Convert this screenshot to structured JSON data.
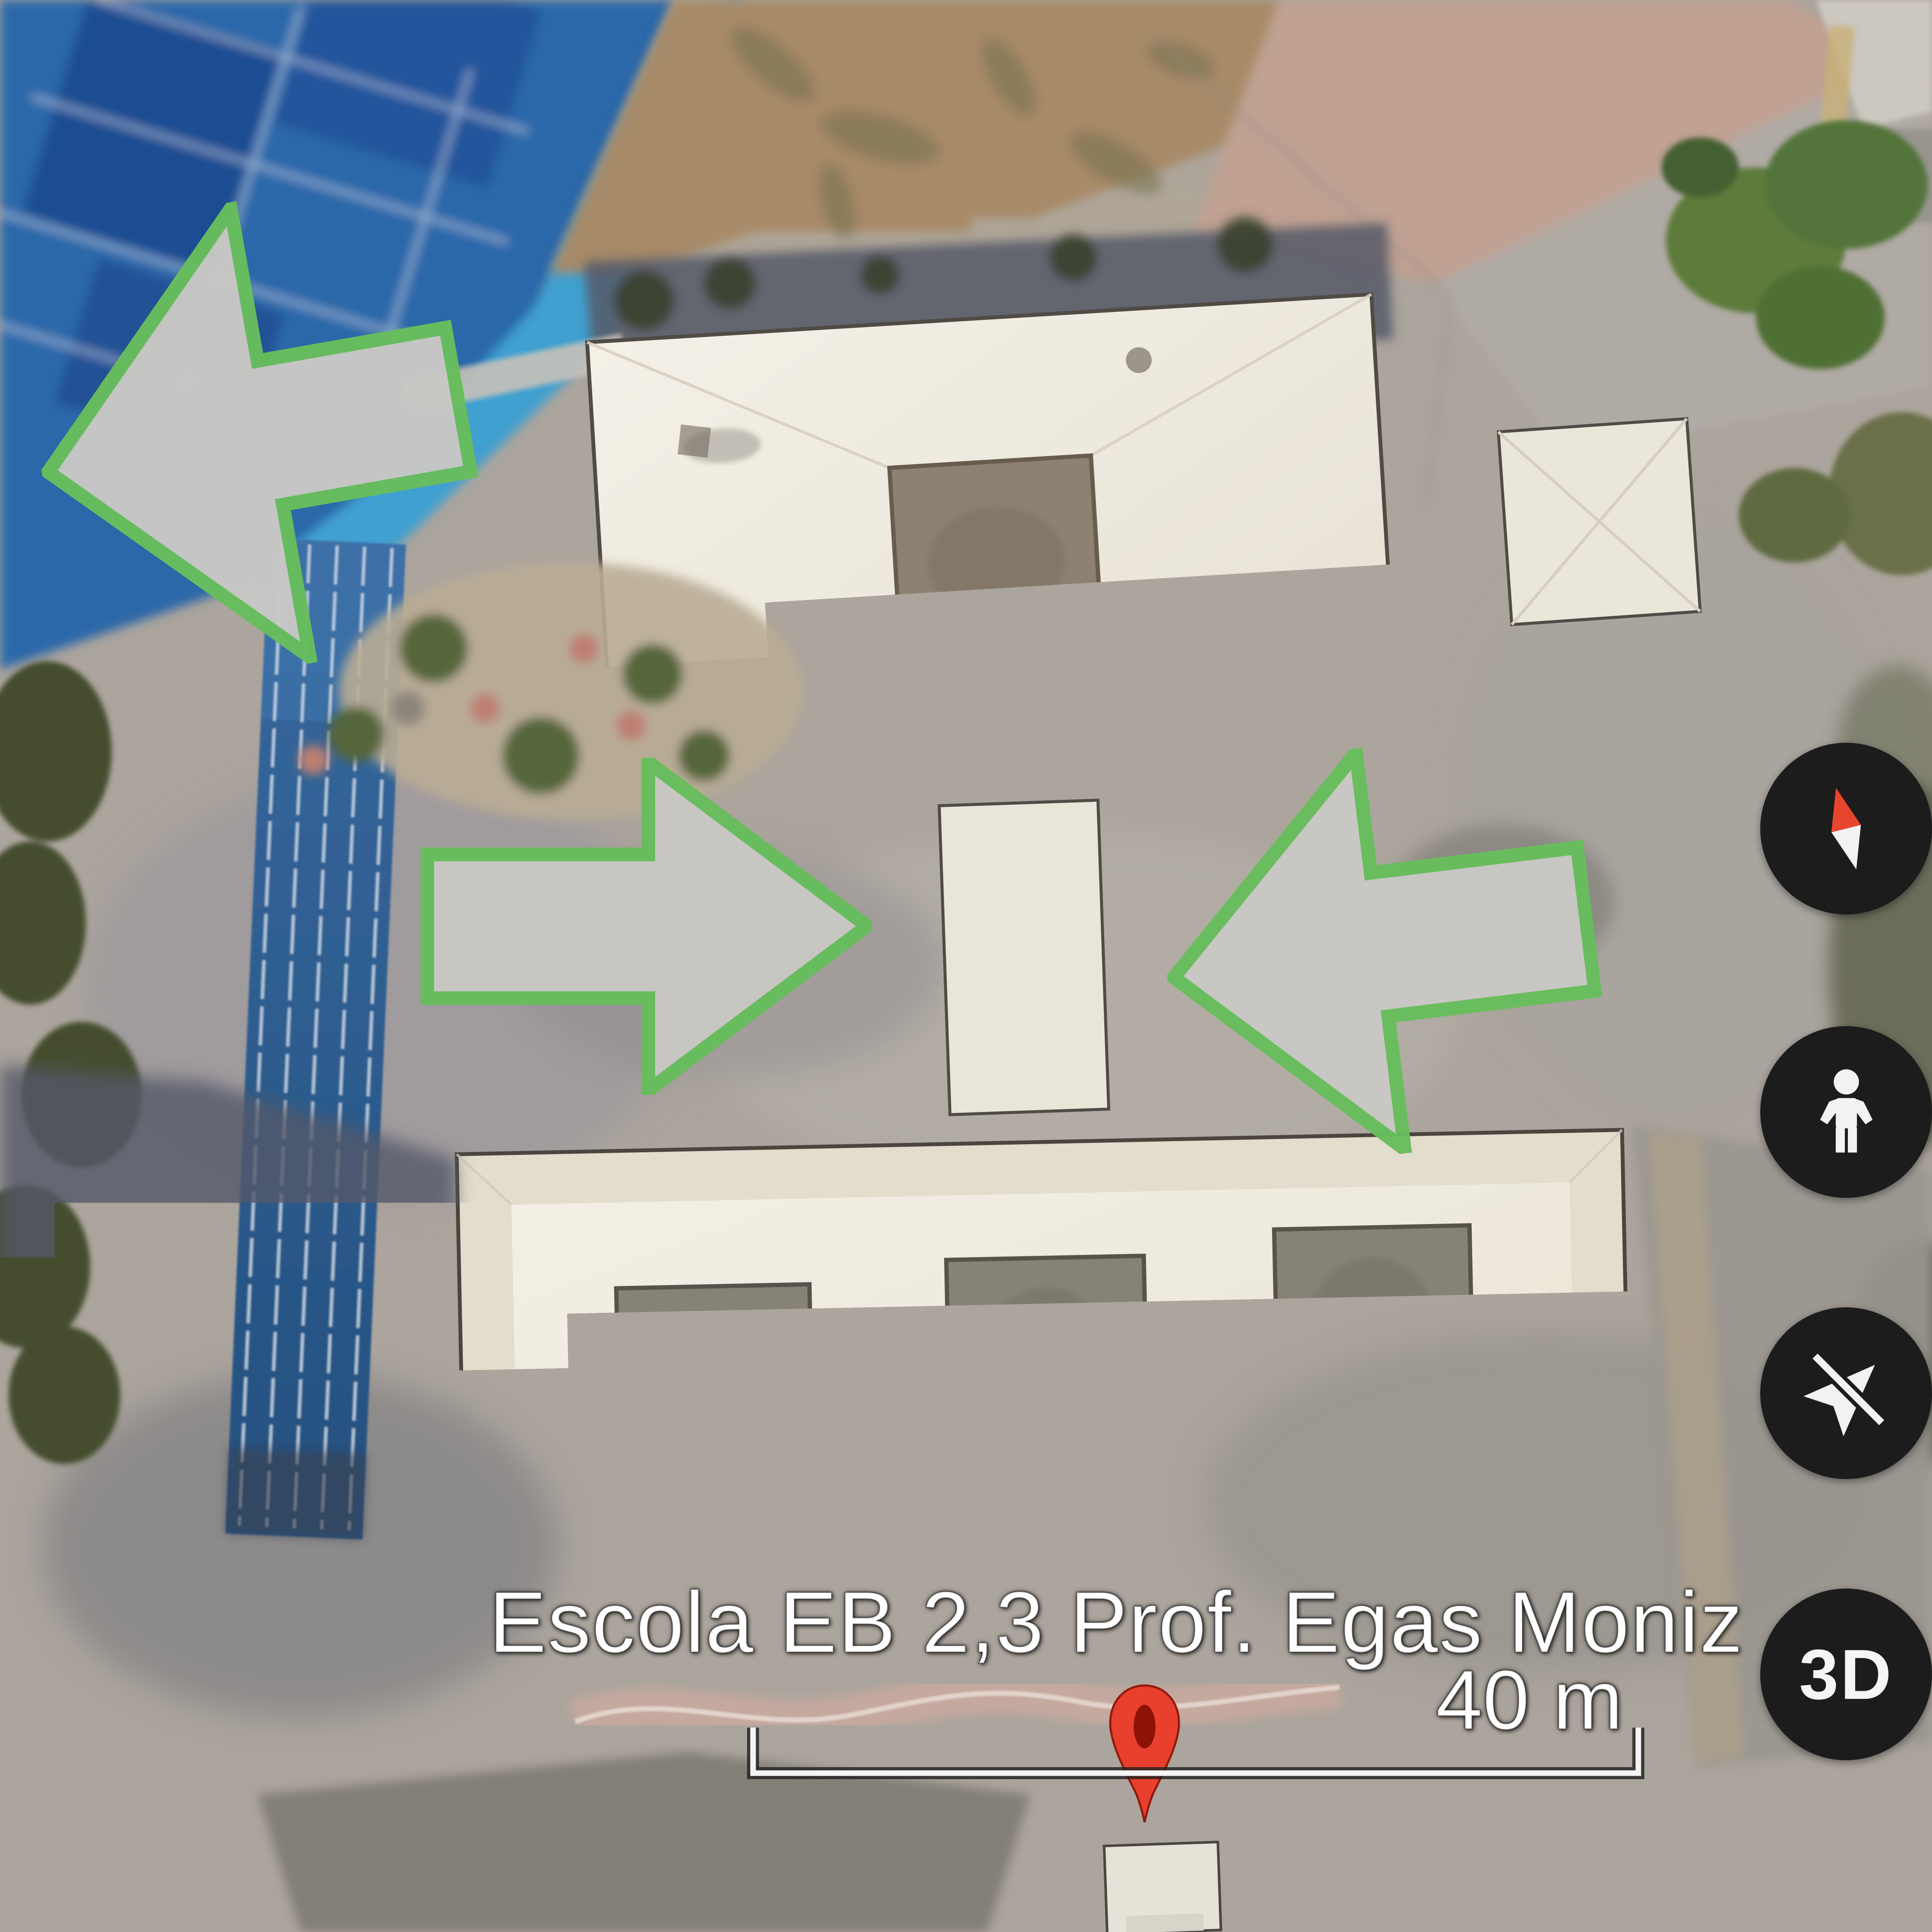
{
  "map_overlay": {
    "place_label": "Escola EB 2,3 Prof. Egas Moniz",
    "scale_label": "40 m",
    "pin": {
      "icon": "map-pin-icon",
      "color": "#e8402d",
      "inner_color": "#8e1206"
    }
  },
  "controls": {
    "compass": {
      "icon": "compass-icon",
      "needle_north_color": "#e8452f",
      "needle_south_color": "#f2f2f2"
    },
    "pegman": {
      "icon": "pegman-icon"
    },
    "navigation_off": {
      "icon": "navigation-off-icon"
    },
    "three_d": {
      "label": "3D"
    },
    "button_background": "#1c1c1c"
  },
  "annotations": {
    "fill": "#c9c8c5",
    "stroke": "#68bd5c",
    "arrows": [
      {
        "id": "arrow-top-left",
        "direction": "left"
      },
      {
        "id": "arrow-middle-left",
        "direction": "right"
      },
      {
        "id": "arrow-middle-right",
        "direction": "left"
      }
    ]
  },
  "terrain_colors": {
    "courts_blue": "#2a67a9",
    "courts_light_blue": "#35a0d6",
    "track_blue": "#2f5f96",
    "roof_white": "#f0ece2",
    "patio_gray": "#868276",
    "tree_green": "#3c4a2a",
    "dirt_tan": "#a78a68",
    "walkway_pink": "#c9a99f"
  }
}
